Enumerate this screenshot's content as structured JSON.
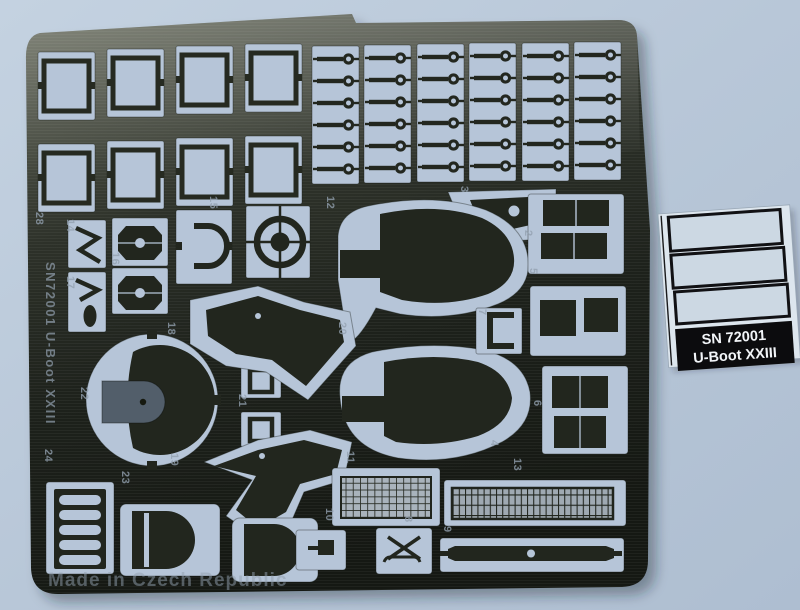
{
  "scene": "photograph of a photo-etched brass fret for a model kit on a light blue background",
  "fret": {
    "vertical_text": "SN72001 U-Boot XXIII",
    "bottom_text": "Made in Czech Republic",
    "part_numbers": [
      "28",
      "14",
      "17",
      "16",
      "15",
      "12",
      "3",
      "2",
      "5",
      "18",
      "20",
      "21",
      "22",
      "7",
      "6",
      "4",
      "19",
      "23",
      "24",
      "11",
      "13",
      "10",
      "8",
      "9"
    ]
  },
  "label_sheet": {
    "line1": "SN 72001",
    "line2": "U-Boot XXIII",
    "decal_box_count": 3
  },
  "colors": {
    "background": "#bac9da",
    "metal_light": "#6a6e60",
    "metal_dark": "#181b15",
    "cutout": "#b6c5d8",
    "label_paper": "#dde6ee",
    "banner_bg": "#0c0c0e",
    "banner_text": "#f2f5f8"
  }
}
